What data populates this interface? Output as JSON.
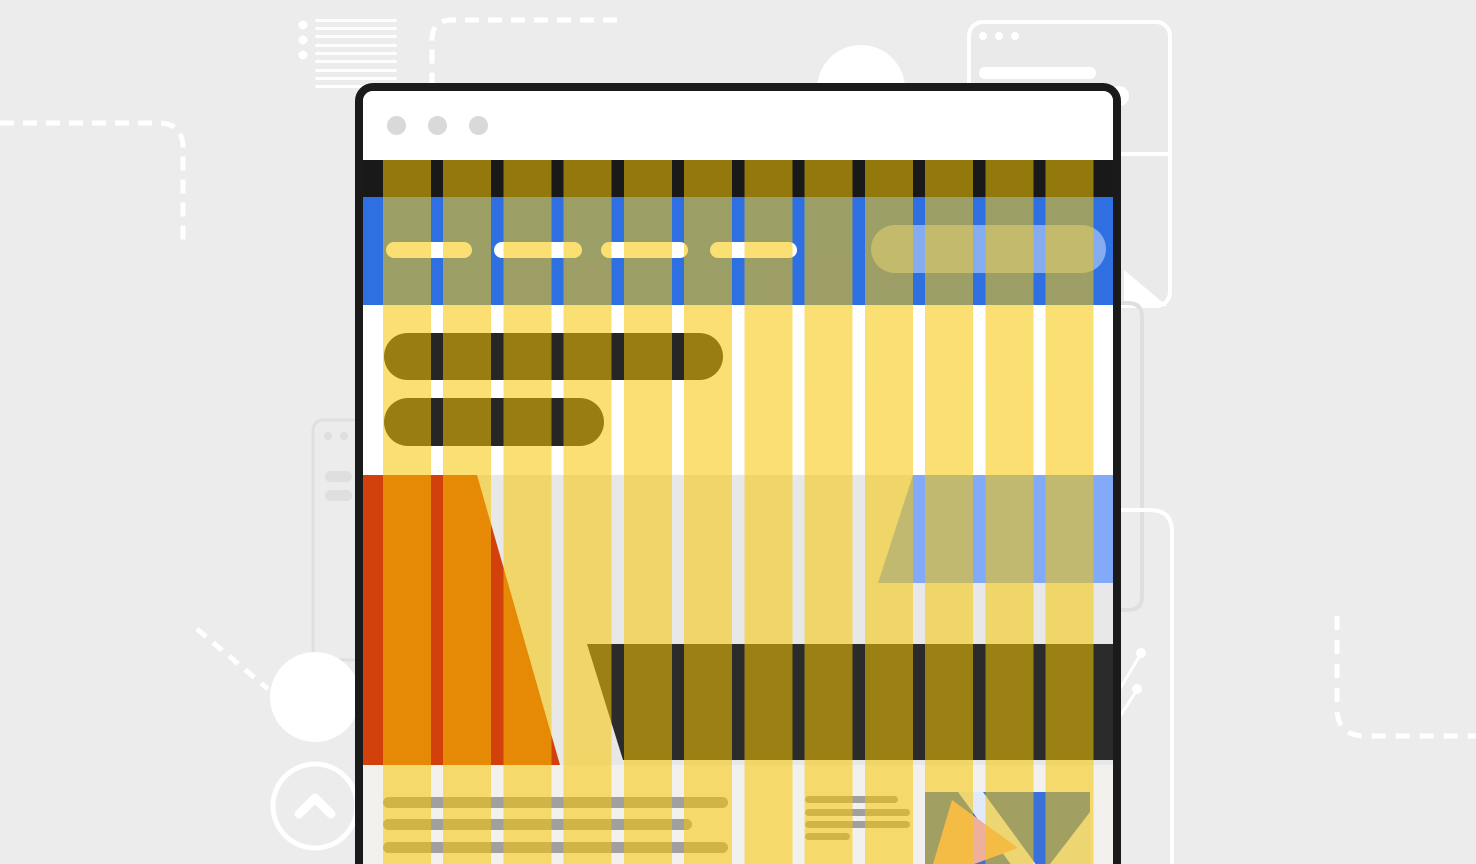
{
  "illustration_title": "Browser window with 12-column grid overlay illustration",
  "colors": {
    "page_bg": "#ececec",
    "window_border": "#1a1a1a",
    "window_titlebar": "#ffffff",
    "titlebar_dot": "#d9d9d9",
    "header_bar": "#191919",
    "nav_blue": "#2e70e2",
    "nav_pill": "#ffffff",
    "search_pill": "rgba(255,255,255,0.42)",
    "content_bg": "#ffffff",
    "heading_pill": "#262626",
    "hero_bg": "#e8e8e8",
    "hero_orange": "#d2410c",
    "hero_blue": "#82aaf8",
    "hero_dark": "#2b2b2b",
    "footer_bg": "#f2f1ed",
    "text_line": "#a0a0a0",
    "thumb_blue": "#3a71da",
    "thumb_salmon": "#efb099",
    "thumb_white": "rgba(255,255,255,0.85)",
    "overlay_fill": "rgba(247,197,0,0.55)",
    "decor_white": "#ffffff",
    "decor_gray": "#dfdfdf",
    "decor_fill": "#eaeaea"
  },
  "grid_overlay": {
    "columns": 12,
    "column_width_px": 48,
    "gutter_px": 12.25,
    "left_margin_px": 20,
    "right_margin_px": 19
  },
  "browser_window": {
    "traffic_light_dots": 3,
    "nav_link_pills": 4,
    "has_search_pill": true,
    "heading_lines": 2,
    "paragraph_lines": 3,
    "list_lines": 4,
    "has_image_thumbnail": true
  }
}
